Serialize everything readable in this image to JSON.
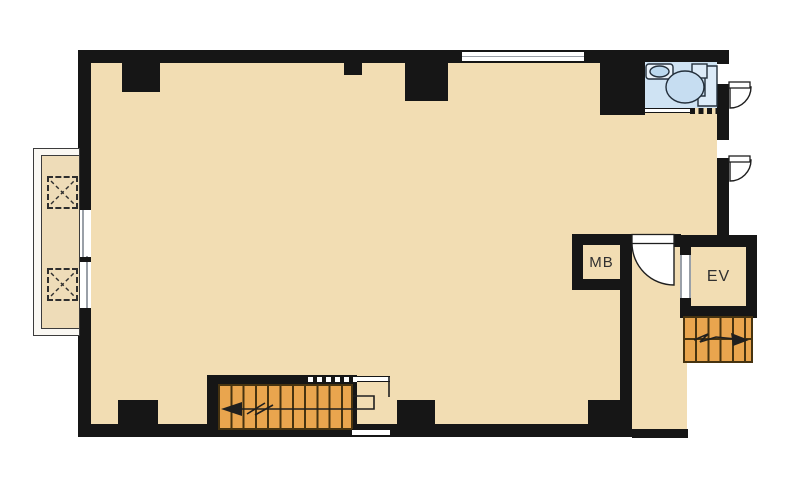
{
  "plan": {
    "type": "floor-plan",
    "rooms": {
      "meter_box_label": "MB",
      "elevator_label": "EV"
    }
  },
  "colors": {
    "wall": "#161616",
    "floor": "#f2ddb3",
    "balcony": "#eedcb8",
    "balconyBase": "#faf8f3",
    "stairs": "#e9a54e",
    "stairLine": "#463310",
    "wet": "#cfe3f3",
    "fixture": "#dcebf8",
    "basin": "#bcd9ef",
    "windowLine": "#9aa0a8",
    "ink": "#1f1f1f",
    "label": "#303030"
  }
}
